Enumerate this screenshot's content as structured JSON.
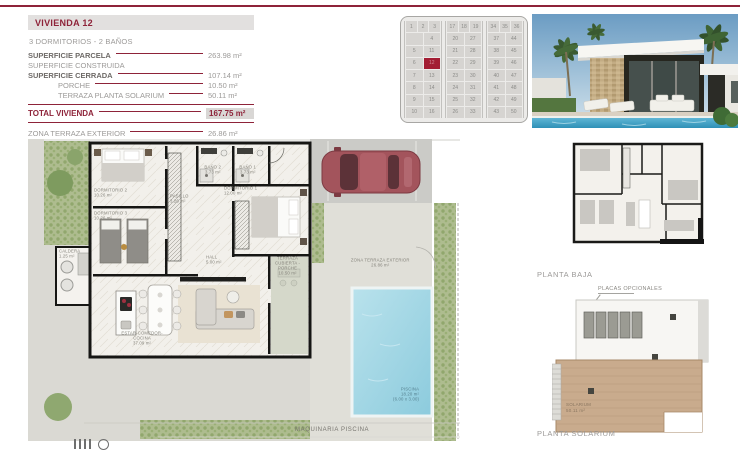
{
  "header": {
    "title": "VIVIENDA 12",
    "subtitle": "3 DORMITORIOS - 2 BAÑOS",
    "specs": [
      {
        "label": "SUPERFICIE PARCELA",
        "value": "263.98 m²"
      },
      {
        "label": "SUPERFICIE CONSTRUIDA",
        "value": ""
      },
      {
        "label": "SUPERFICIE CERRADA",
        "value": "107.14 m²"
      },
      {
        "label": "PORCHE",
        "value": "10.50 m²"
      },
      {
        "label": "TERRAZA PLANTA SOLARIUM",
        "value": "50.11 m²"
      }
    ],
    "total": {
      "label": "TOTAL VIVIENDA",
      "value": "167.75 m²"
    },
    "zona": {
      "label": "ZONA TERRAZA EXTERIOR",
      "value": "26.86 m²"
    }
  },
  "site_grid": {
    "selected": "12",
    "blocks": [
      {
        "rows": [
          [
            "1",
            "2",
            "3"
          ],
          [
            "",
            "4"
          ],
          [
            "5",
            "11"
          ],
          [
            "6",
            "12"
          ],
          [
            "7",
            "13"
          ],
          [
            "8",
            "14"
          ],
          [
            "9",
            "15"
          ],
          [
            "10",
            "16"
          ]
        ]
      },
      {
        "rows": [
          [
            "17",
            "18",
            "19"
          ],
          [
            "20",
            "27"
          ],
          [
            "21",
            "28"
          ],
          [
            "22",
            "29"
          ],
          [
            "23",
            "30"
          ],
          [
            "24",
            "31"
          ],
          [
            "25",
            "32"
          ],
          [
            "26",
            "33"
          ]
        ]
      },
      {
        "rows": [
          [
            "34",
            "35",
            "36"
          ],
          [
            "37",
            "44"
          ],
          [
            "38",
            "45"
          ],
          [
            "39",
            "46"
          ],
          [
            "40",
            "47"
          ],
          [
            "41",
            "48"
          ],
          [
            "42",
            "49"
          ],
          [
            "43",
            "50"
          ]
        ]
      }
    ]
  },
  "floor_plan": {
    "rooms": {
      "dormitorio2": {
        "name": "DORMITORIO 2",
        "area": "10.26 m²"
      },
      "dormitorio3": {
        "name": "DORMITORIO 3",
        "area": "10.26 m²"
      },
      "pasillo": {
        "name": "PASILLO",
        "area": "3.26 m²"
      },
      "bano2": {
        "name": "BAÑO 2",
        "area": "3.73 m²"
      },
      "bano1": {
        "name": "BAÑO 1",
        "area": "3.73 m²"
      },
      "dormitorio1": {
        "name": "DORMITORIO 1",
        "area": "12.00 m²"
      },
      "hall": {
        "name": "HALL",
        "area": "5.00 m²"
      },
      "estar": {
        "name": "ESTAR-COMEDOR-COCINA",
        "area": "37.09 m²"
      },
      "porche": {
        "name": "TERRAZA CUBIERTA -PORCHE",
        "area": "10.50 m²"
      },
      "caldera": {
        "name": "CALDERA",
        "area": "1.25 m²"
      }
    },
    "pool": {
      "name": "PISCINA",
      "area": "18.20 m²",
      "dims": "(6.00 x 3.00)"
    },
    "zona_terraza": {
      "name": "ZONA TERRAZA EXTERIOR",
      "area": "26.86 m²"
    },
    "maquinaria_label": "MAQUINARIA PISCINA"
  },
  "right_plans": {
    "planta_baja_label": "PLANTA BAJA",
    "placas_label": "PLACAS OPCIONALES",
    "solarium": {
      "name": "SOLARIUM",
      "area": "50.11 m²"
    },
    "planta_solarium_label": "PLANTA SOLARIUM"
  },
  "colors": {
    "accent": "#8e2339",
    "selected_cell": "#a31d33",
    "pool": "#9fd4e4",
    "garden": "#aebc8f",
    "deck_wood": "#c9ab8d"
  }
}
